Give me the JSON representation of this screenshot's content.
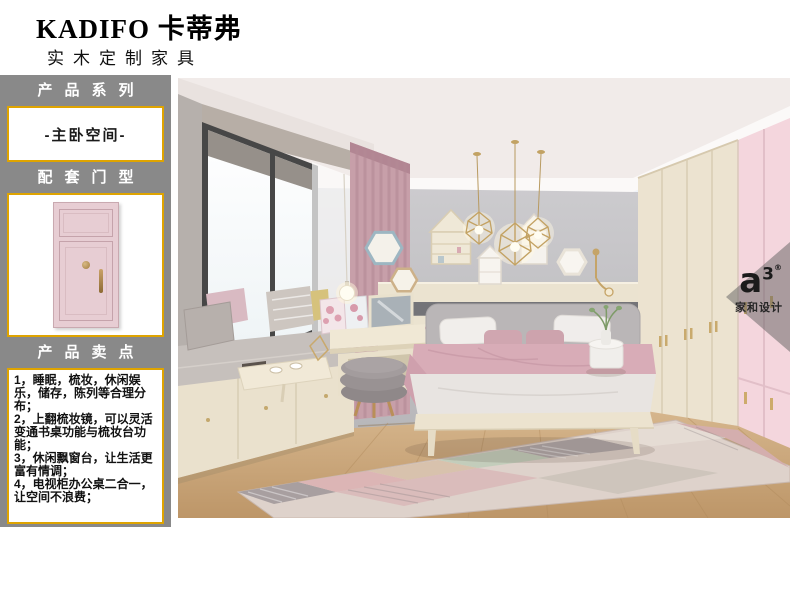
{
  "header": {
    "brand": "KADIFO 卡蒂弗",
    "tagline": "实木定制家具"
  },
  "sidebar": {
    "series_label": "产品系列",
    "series_value": "-主卧空间-",
    "door_type_label": "配套门型",
    "selling_points_label": "产品卖点",
    "selling_points": [
      "1，睡眠，梳妆，休闲娱乐，储存，陈列等合理分布；",
      "2，上翻梳妆镜，可以灵活变通书桌功能与梳妆台功能；",
      "3，休闲飘窗台，让生活更富有情调；",
      "4，电视柜办公桌二合一，让空间不浪费；"
    ]
  },
  "watermark": {
    "logo": "a",
    "logo_sup": "3",
    "reg": "®",
    "brand": "家和设计"
  },
  "colors": {
    "sidebar_bg": "#898989",
    "accent_gold": "#dfa400",
    "door_pink": "#e7cdd3",
    "wardrobe_pink": "#f4d6dd",
    "wardrobe_cream": "#ece3d0",
    "wall_gray": "#c5c4c7"
  }
}
